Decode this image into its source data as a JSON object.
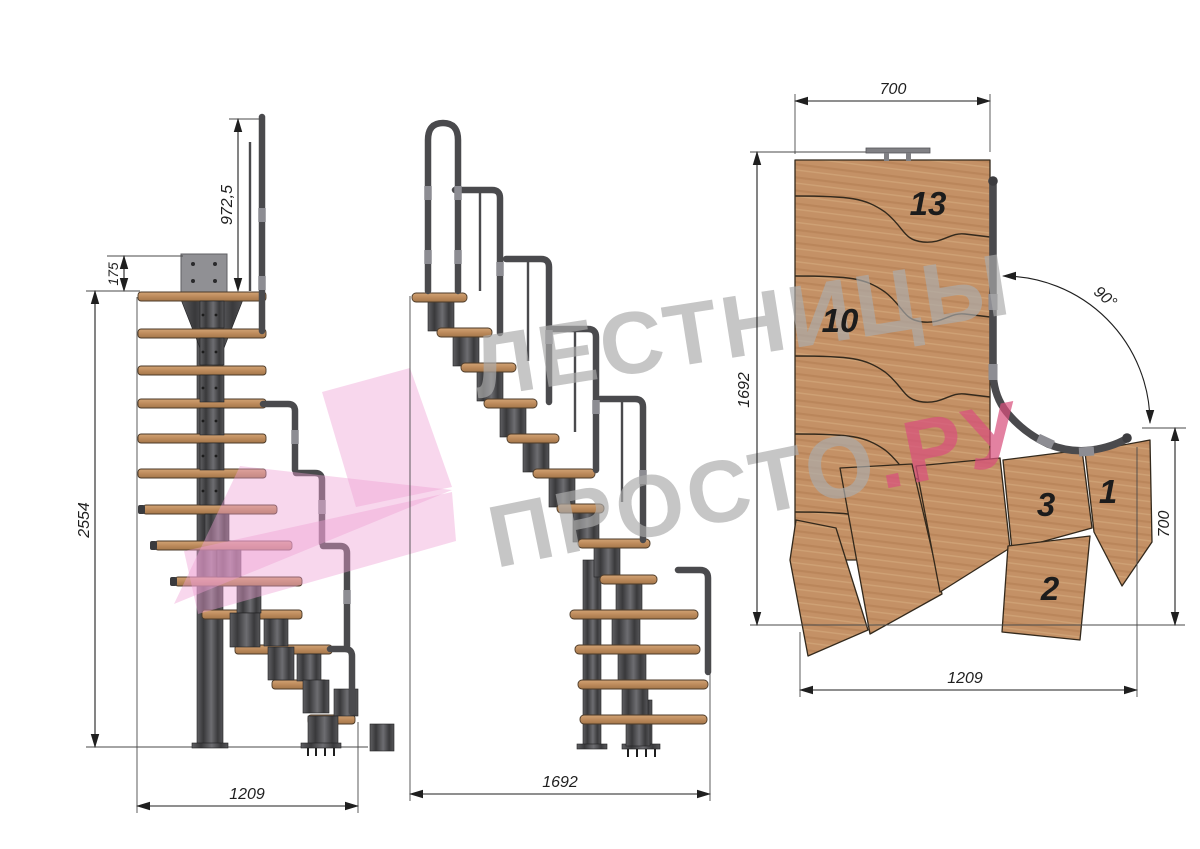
{
  "watermark": {
    "line1": "ЛЕСТНИЦЫ",
    "line2_gray": "ПРОСТО",
    "line2_pink": ".РУ"
  },
  "views": {
    "side": {
      "dims": {
        "rail_height": "972,5",
        "plate_height": "175",
        "total_height": "2554",
        "run_length": "1209"
      }
    },
    "front": {
      "dims": {
        "run_length": "1692"
      }
    },
    "plan": {
      "dims": {
        "top_width": "700",
        "left_length": "1692",
        "turn_angle": "90°",
        "right_width": "700",
        "bottom_length": "1209"
      },
      "step_labels": {
        "s13": "13",
        "s10": "10",
        "s3": "3",
        "s1": "1",
        "s2": "2"
      }
    }
  },
  "colors": {
    "wood": "#c49166",
    "wood_dark": "#9a7248",
    "wood_stroke": "#4b3a28",
    "metal": "#4a4a4d",
    "metal_dark": "#2f2f31",
    "metal_light": "#77777b",
    "plate": "#909094",
    "dim": "#1f1f1f",
    "watermark_gray": "#ababab",
    "watermark_pink": "#d8507d",
    "logo_pink": "#ef9fd3"
  }
}
